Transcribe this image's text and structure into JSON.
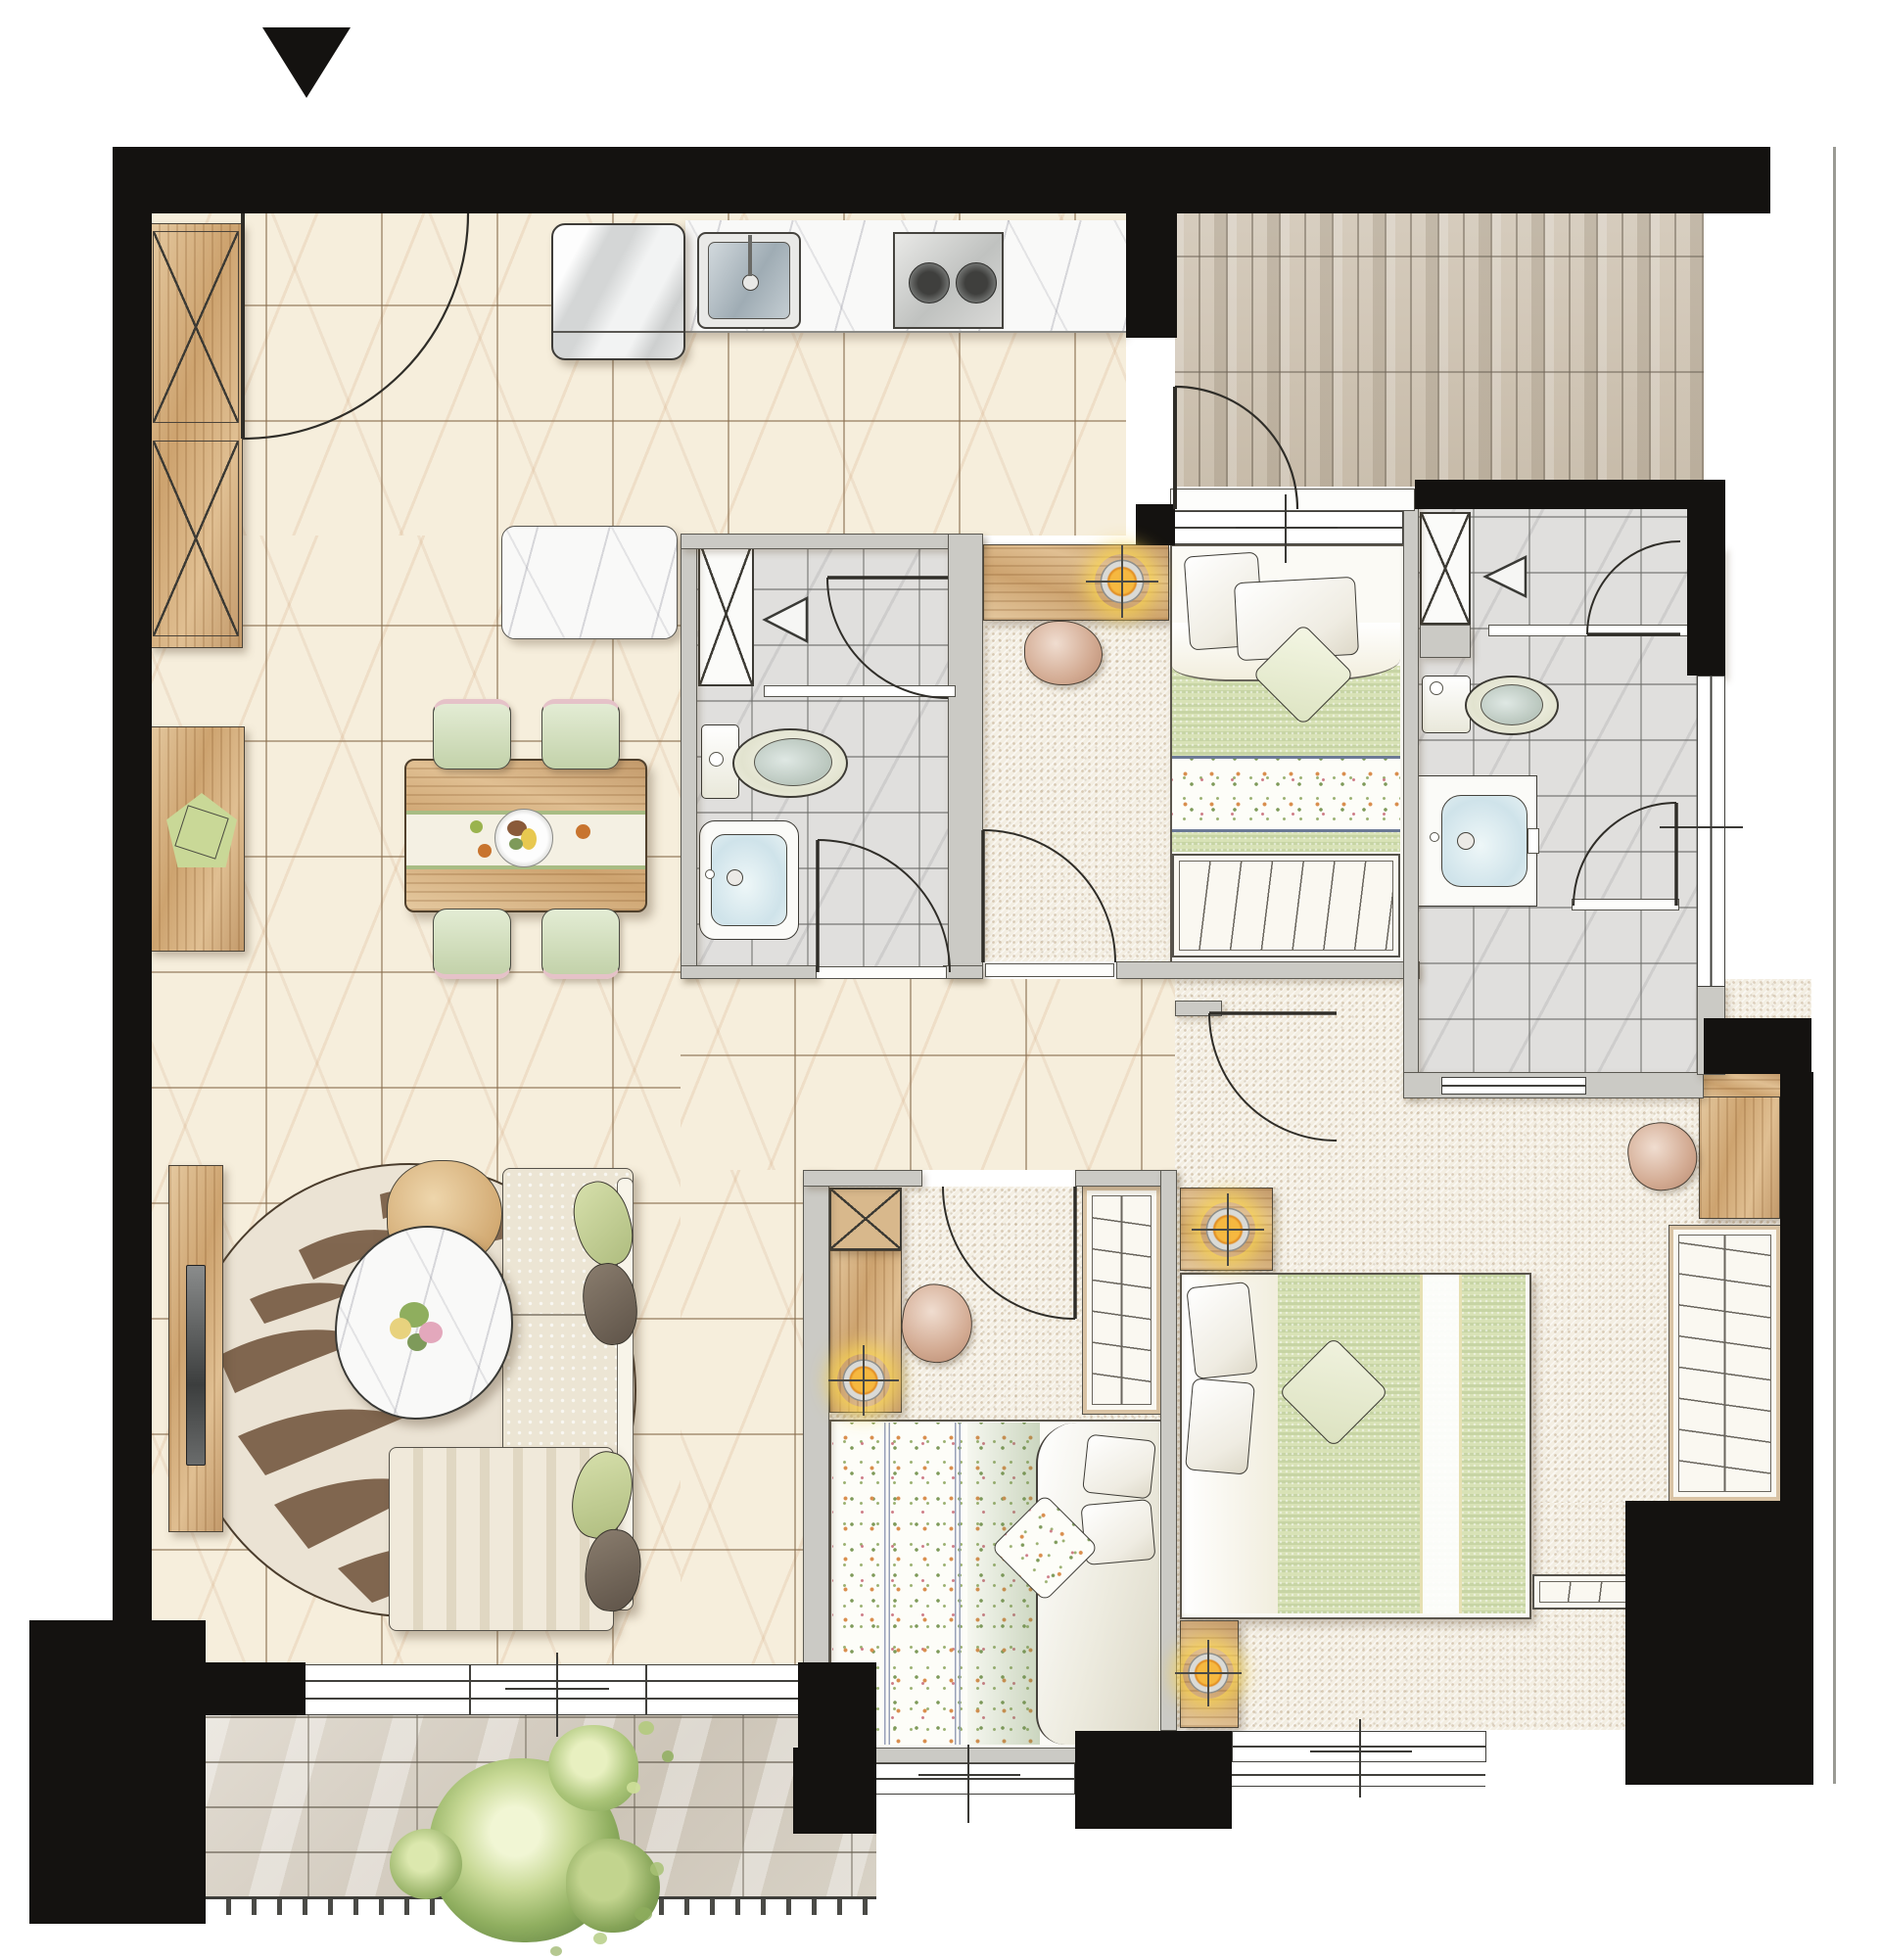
{
  "image_type": "residential floor plan rendering (top-down interior view, no text labels)",
  "orientation_marker": {
    "name": "entry-direction-triangle",
    "shape": "solid triangle pointing down",
    "color": "#141210"
  },
  "palette": {
    "wall_black": "#141210",
    "wall_gray": "#cbcac5",
    "floor_marble_cream": "#f6eedc",
    "floor_tile_gray": "#e0dfdd",
    "floor_carpet": "#f3eee2",
    "floor_plank_taupe": "#cfc4b3",
    "floor_brick": "#dcd6cc",
    "wood": "#d8b88c",
    "counter_marble": "#f9f9f8",
    "quilt_green": "#d8e2b6",
    "downlight_orange": "#e08a1e",
    "downlight_glow": "#fad650",
    "stripe_blue": "#97a0b8",
    "plant_green": "#8fae5e"
  },
  "rooms": [
    {
      "label": "Entry & Kitchen",
      "floor": "cream marble tile"
    },
    {
      "label": "Dining Area",
      "floor": "cream marble tile"
    },
    {
      "label": "Living Area",
      "floor": "cream marble tile"
    },
    {
      "label": "Entrance Foyer (plank tile)",
      "floor": "taupe plank tile"
    },
    {
      "label": "Bathroom 1",
      "floor": "gray stone tile"
    },
    {
      "label": "Bedroom 2",
      "floor": "carpet"
    },
    {
      "label": "Bathroom 2",
      "floor": "gray stone tile"
    },
    {
      "label": "Hallway",
      "floor": "cream marble tile"
    },
    {
      "label": "Bedroom 3",
      "floor": "carpet"
    },
    {
      "label": "Master Bedroom",
      "floor": "carpet"
    },
    {
      "label": "Balcony",
      "floor": "brick paving"
    }
  ],
  "fixtures": {
    "entry_door": "Entry door swing",
    "foyer_door": "Foyer door swing",
    "shoe_cabinet": "Tall entry cabinet",
    "sideboard": "Sideboard with decor",
    "fridge": "Refrigerator",
    "kitchen_counter": "Kitchen counter",
    "kitchen_sink": "Kitchen sink",
    "stove": "Two-burner cooktop",
    "island": "Kitchen island counter",
    "dining_table": "Dining table with runner and fruit plate",
    "dining_chair": "Dining chair",
    "tv_wall": "TV media wall",
    "tv": "Wall-mounted TV",
    "rug": "Round zebra-pattern rug",
    "coffee_table": "Organic marble coffee table with flowers",
    "stool": "Wood stool",
    "sofa": "Fabric sofa",
    "chaise": "Striped chaise / daybed",
    "cushion": "Throw cushion",
    "shaft": "Vent / pipe shaft",
    "shower_head": "Shower head symbol",
    "shower_screen": "Shower glass screen",
    "toilet": "Toilet",
    "basin": "Wash basin",
    "desk": "Desk",
    "desk_chair": "Desk chair",
    "downlight": "Recessed downlight symbol",
    "single_bed": "Single bed with green quilt and floral band",
    "double_bed_floral": "Double bed with floral quilt",
    "double_bed_green": "Double bed with green striped quilt",
    "book_rack": "Low shelf rack",
    "wardrobe": "Wardrobe with hanging rail",
    "nightstand": "Nightstand with downlight",
    "bench": "Foot-of-bed bench",
    "sliding_door": "Balcony sliding door",
    "window": "Window",
    "plant": "Balcony plant",
    "railing": "Balcony railing"
  }
}
